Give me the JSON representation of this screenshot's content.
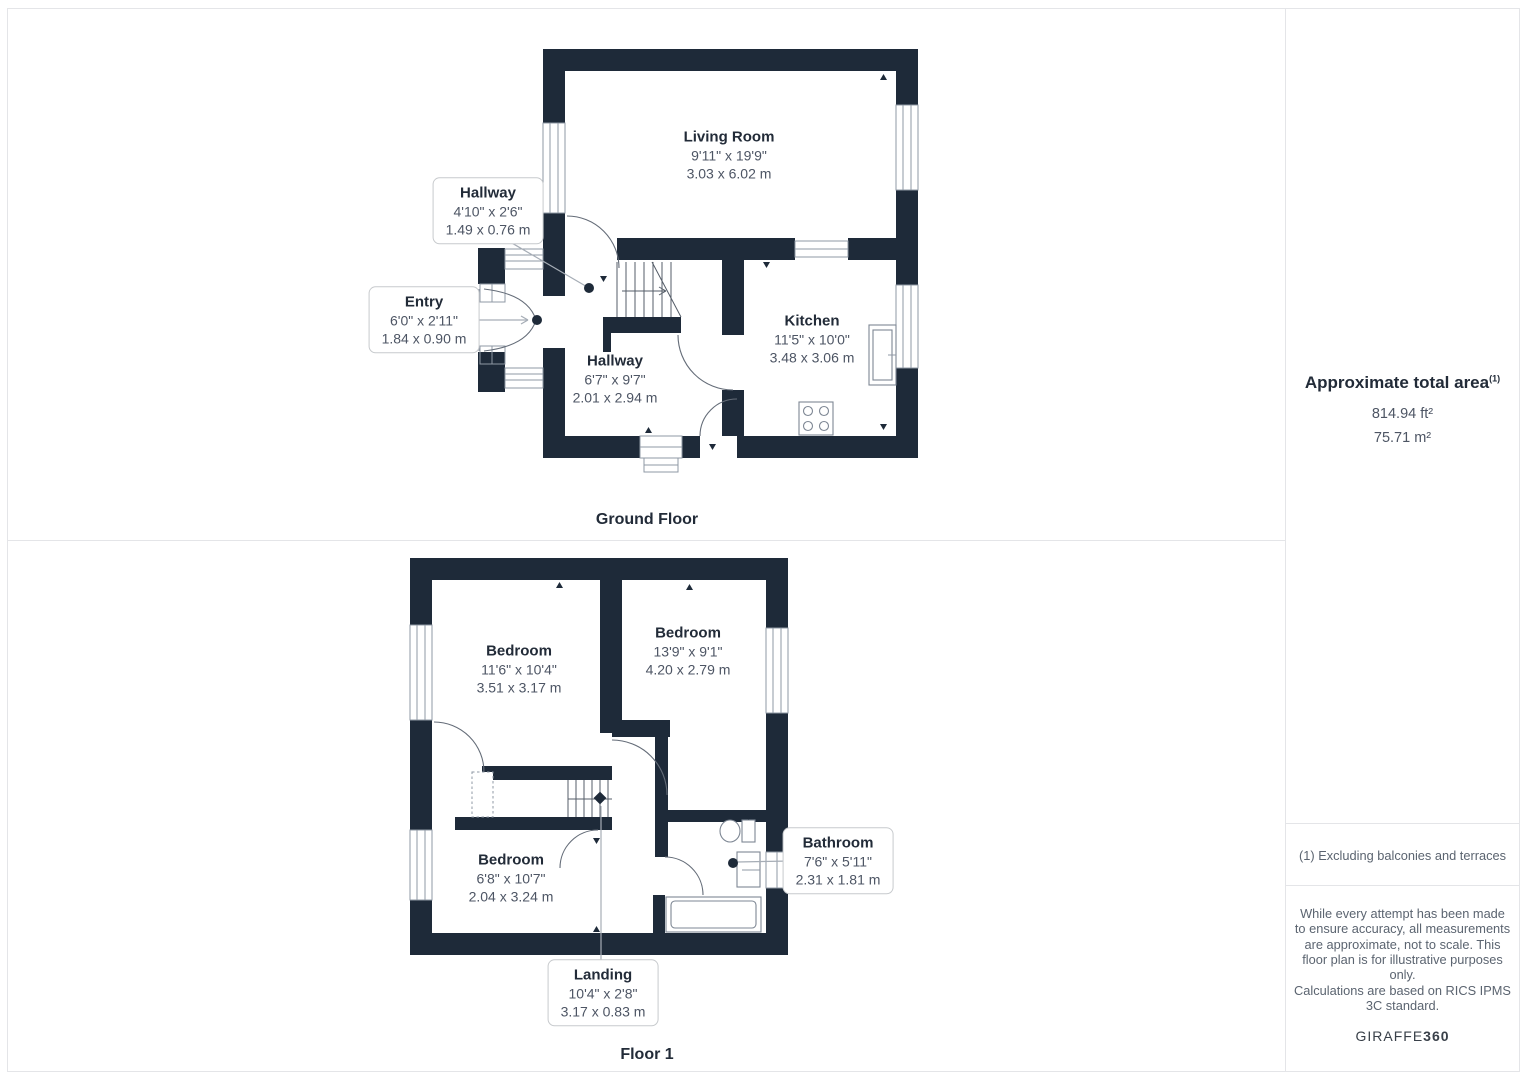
{
  "colors": {
    "wall": "#1e2a39",
    "room_title": "#222b38",
    "dimension_text": "#4d5564",
    "divider": "#e4e5e8",
    "muted_text": "#5b6470",
    "leader": "#a6adb6"
  },
  "ground_floor": {
    "caption": "Ground Floor",
    "living_room": {
      "name": "Living Room",
      "imperial": "9'11\" x 19'9\"",
      "metric": "3.03 x 6.02 m"
    },
    "hallway_small": {
      "name": "Hallway",
      "imperial": "4'10\" x 2'6\"",
      "metric": "1.49 x 0.76 m"
    },
    "entry": {
      "name": "Entry",
      "imperial": "6'0\" x 2'11\"",
      "metric": "1.84 x 0.90 m"
    },
    "hallway": {
      "name": "Hallway",
      "imperial": "6'7\" x 9'7\"",
      "metric": "2.01 x 2.94 m"
    },
    "kitchen": {
      "name": "Kitchen",
      "imperial": "11'5\" x 10'0\"",
      "metric": "3.48 x 3.06 m"
    }
  },
  "floor_1": {
    "caption": "Floor 1",
    "bedroom_left": {
      "name": "Bedroom",
      "imperial": "11'6\" x 10'4\"",
      "metric": "3.51 x 3.17 m"
    },
    "bedroom_right": {
      "name": "Bedroom",
      "imperial": "13'9\" x 9'1\"",
      "metric": "4.20 x 2.79 m"
    },
    "bedroom_bottom": {
      "name": "Bedroom",
      "imperial": "6'8\" x 10'7\"",
      "metric": "2.04 x 3.24 m"
    },
    "bathroom": {
      "name": "Bathroom",
      "imperial": "7'6\" x 5'11\"",
      "metric": "2.31 x 1.81 m"
    },
    "landing": {
      "name": "Landing",
      "imperial": "10'4\" x 2'8\"",
      "metric": "3.17 x 0.83 m"
    }
  },
  "sidebar": {
    "area_title": "Approximate total area",
    "area_footnote_marker": "(1)",
    "area_imperial": "814.94 ft²",
    "area_metric": "75.71 m²",
    "footnote": "(1) Excluding balconies and terraces",
    "disclaimer_accuracy": "While every attempt has been made to ensure accuracy, all measurements are approximate, not to scale. This floor plan is for illustrative purposes only.",
    "disclaimer_standard": "Calculations are based on RICS IPMS 3C standard.",
    "brand_name": "GIRAFFE",
    "brand_number": "360"
  }
}
